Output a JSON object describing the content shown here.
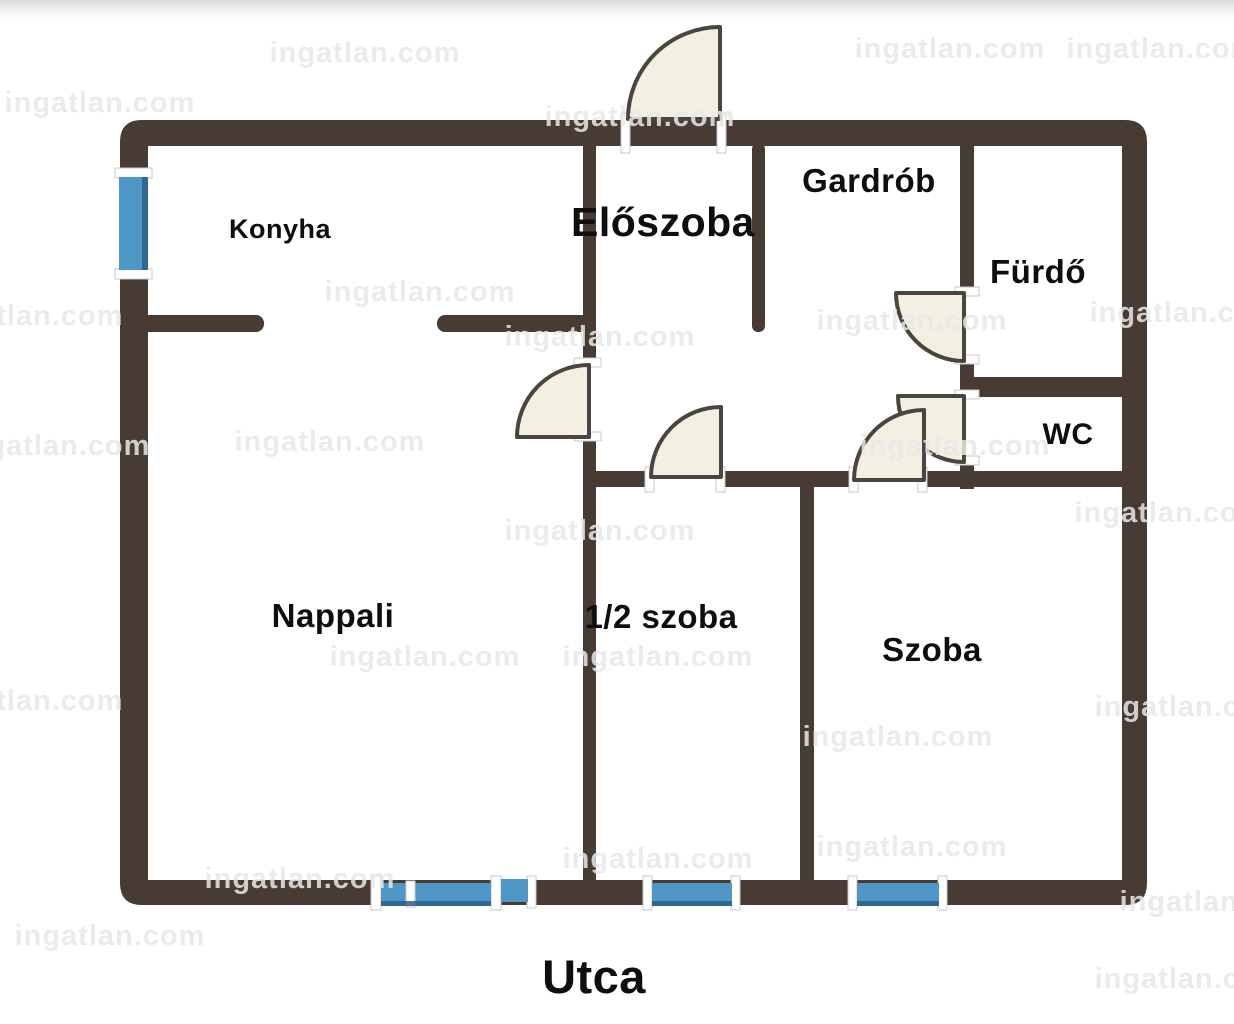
{
  "page": {
    "background": "#ffffff"
  },
  "colors": {
    "wall": "#483b33",
    "window_blue": "#4e97c6",
    "window_edge": "#2e5f82",
    "door_fill": "#f4efe3",
    "door_stroke": "#4a453f",
    "label": "#0e0e0e",
    "watermark": "#e8e8e8"
  },
  "rooms": {
    "konyha": {
      "label": "Konyha",
      "x": 280,
      "y": 238,
      "size": 27
    },
    "eloszoba": {
      "label": "Előszoba",
      "x": 663,
      "y": 236,
      "size": 41
    },
    "gardrob": {
      "label": "Gardrób",
      "x": 869,
      "y": 192,
      "size": 33
    },
    "furdo": {
      "label": "Fürdő",
      "x": 1038,
      "y": 283,
      "size": 33
    },
    "wc": {
      "label": "WC",
      "x": 1068,
      "y": 444,
      "size": 30
    },
    "nappali": {
      "label": "Nappali",
      "x": 333,
      "y": 627,
      "size": 33
    },
    "felszoba": {
      "label": "1/2 szoba",
      "x": 661,
      "y": 628,
      "size": 33
    },
    "szoba": {
      "label": "Szoba",
      "x": 932,
      "y": 661,
      "size": 33
    }
  },
  "street": {
    "label": "Utca",
    "x": 594,
    "y": 993,
    "size": 47
  },
  "watermarks": {
    "text": "ingatlan.com",
    "size": 29,
    "items": [
      {
        "x": 365,
        "y": 62
      },
      {
        "x": 950,
        "y": 58
      },
      {
        "x": 1162,
        "y": 58
      },
      {
        "x": 100,
        "y": 112
      },
      {
        "x": 640,
        "y": 126
      },
      {
        "x": 28,
        "y": 325
      },
      {
        "x": 420,
        "y": 301
      },
      {
        "x": 600,
        "y": 346
      },
      {
        "x": 912,
        "y": 330
      },
      {
        "x": 1185,
        "y": 322
      },
      {
        "x": 55,
        "y": 455
      },
      {
        "x": 330,
        "y": 451
      },
      {
        "x": 955,
        "y": 455
      },
      {
        "x": 600,
        "y": 540
      },
      {
        "x": 1170,
        "y": 522
      },
      {
        "x": 425,
        "y": 666
      },
      {
        "x": 658,
        "y": 666
      },
      {
        "x": 28,
        "y": 710
      },
      {
        "x": 1190,
        "y": 716
      },
      {
        "x": 898,
        "y": 746
      },
      {
        "x": 912,
        "y": 856
      },
      {
        "x": 300,
        "y": 888
      },
      {
        "x": 658,
        "y": 868
      },
      {
        "x": 110,
        "y": 945
      },
      {
        "x": 1215,
        "y": 911
      },
      {
        "x": 1190,
        "y": 988
      }
    ]
  }
}
